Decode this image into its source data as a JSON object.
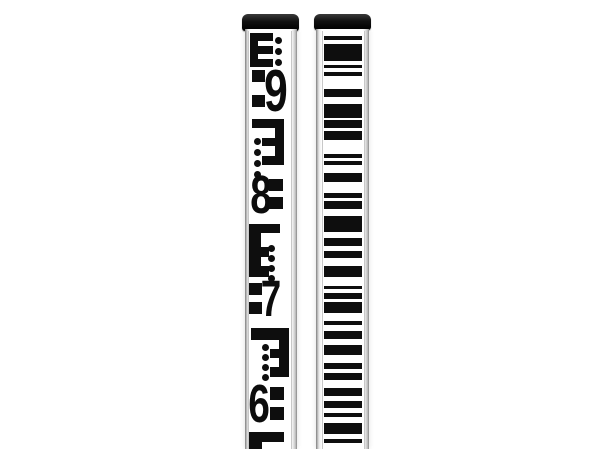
{
  "scene": {
    "description": "Product photograph of two telescopic surveying leveling staffs standing vertically on a white background",
    "background": "#ffffff"
  },
  "colors": {
    "ink": "#0e0e0e",
    "cap": "#141414",
    "aluminum_light": "#f1f1f1",
    "aluminum_dark": "#868686",
    "face": "#ffffff"
  },
  "left_staff": {
    "kind": "E-face metric leveling staff",
    "digits_visible": [
      "9",
      "8",
      "7",
      "6"
    ],
    "face": {
      "x": 245,
      "y": 28,
      "body_w": 52,
      "face_offset": 3,
      "face_w": 42
    },
    "marks": [
      {
        "t": "rect",
        "x": 1,
        "y": 2,
        "w": 8,
        "h": 34
      },
      {
        "t": "rect",
        "x": 1,
        "y": 2,
        "w": 23,
        "h": 8
      },
      {
        "t": "rect",
        "x": 1,
        "y": 15,
        "w": 23,
        "h": 8
      },
      {
        "t": "rect",
        "x": 1,
        "y": 28,
        "w": 23,
        "h": 8
      },
      {
        "t": "dots",
        "x": 26,
        "y": 6,
        "d": 7,
        "gap": 11,
        "n": 4
      },
      {
        "t": "digit",
        "char": "9",
        "x": 16,
        "y": 37,
        "w": 22,
        "h": 46
      },
      {
        "t": "rect",
        "x": 3,
        "y": 39,
        "w": 13,
        "h": 12
      },
      {
        "t": "rect",
        "x": 3,
        "y": 64,
        "w": 13,
        "h": 12
      },
      {
        "t": "rect",
        "x": 3,
        "y": 88,
        "w": 32,
        "h": 9
      },
      {
        "t": "rect",
        "x": 26,
        "y": 88,
        "w": 9,
        "h": 46
      },
      {
        "t": "rect",
        "x": 13,
        "y": 107,
        "w": 22,
        "h": 8
      },
      {
        "t": "rect",
        "x": 13,
        "y": 125,
        "w": 22,
        "h": 9
      },
      {
        "t": "dots",
        "x": 5,
        "y": 107,
        "d": 7,
        "gap": 11,
        "n": 4
      },
      {
        "t": "digit",
        "char": "8",
        "x": 2,
        "y": 143,
        "w": 20,
        "h": 42
      },
      {
        "t": "rect",
        "x": 20,
        "y": 148,
        "w": 14,
        "h": 12
      },
      {
        "t": "rect",
        "x": 20,
        "y": 166,
        "w": 14,
        "h": 12
      },
      {
        "t": "rect",
        "x": 0,
        "y": 193,
        "w": 31,
        "h": 9
      },
      {
        "t": "rect",
        "x": 0,
        "y": 193,
        "w": 12,
        "h": 53
      },
      {
        "t": "rect",
        "x": 0,
        "y": 216,
        "w": 20,
        "h": 10
      },
      {
        "t": "rect",
        "x": 0,
        "y": 235,
        "w": 20,
        "h": 11
      },
      {
        "t": "dots",
        "x": 19,
        "y": 214,
        "d": 7,
        "gap": 10,
        "n": 4
      },
      {
        "t": "digit",
        "char": "7",
        "x": 13,
        "y": 248,
        "w": 18,
        "h": 40
      },
      {
        "t": "rect",
        "x": 0,
        "y": 252,
        "w": 13,
        "h": 12
      },
      {
        "t": "rect",
        "x": 0,
        "y": 271,
        "w": 13,
        "h": 12
      },
      {
        "t": "rect",
        "x": 2,
        "y": 297,
        "w": 38,
        "h": 12
      },
      {
        "t": "rect",
        "x": 30,
        "y": 297,
        "w": 10,
        "h": 49
      },
      {
        "t": "rect",
        "x": 21,
        "y": 318,
        "w": 19,
        "h": 9
      },
      {
        "t": "rect",
        "x": 21,
        "y": 336,
        "w": 19,
        "h": 10
      },
      {
        "t": "dots",
        "x": 13,
        "y": 313,
        "d": 7,
        "gap": 10,
        "n": 4
      },
      {
        "t": "digit",
        "char": "6",
        "x": 0,
        "y": 352,
        "w": 20,
        "h": 42
      },
      {
        "t": "rect",
        "x": 21,
        "y": 356,
        "w": 14,
        "h": 13
      },
      {
        "t": "rect",
        "x": 21,
        "y": 376,
        "w": 14,
        "h": 13
      },
      {
        "t": "rect",
        "x": 0,
        "y": 401,
        "w": 35,
        "h": 10
      },
      {
        "t": "rect",
        "x": 0,
        "y": 401,
        "w": 13,
        "h": 18
      }
    ]
  },
  "right_staff": {
    "kind": "barcode leveling staff for digital levels",
    "face": {
      "x": 316,
      "y": 28,
      "body_w": 53,
      "face_offset": 6,
      "face_w": 41
    },
    "bars": [
      [
        5,
        4
      ],
      [
        13,
        17
      ],
      [
        34,
        3
      ],
      [
        41,
        4
      ],
      [
        58,
        8
      ],
      [
        73,
        14
      ],
      [
        89,
        8
      ],
      [
        100,
        9
      ],
      [
        123,
        4
      ],
      [
        130,
        4
      ],
      [
        142,
        9
      ],
      [
        162,
        5
      ],
      [
        170,
        8
      ],
      [
        185,
        16
      ],
      [
        207,
        8
      ],
      [
        220,
        7
      ],
      [
        235,
        11
      ],
      [
        255,
        3
      ],
      [
        262,
        6
      ],
      [
        271,
        11
      ],
      [
        290,
        4
      ],
      [
        300,
        8
      ],
      [
        314,
        10
      ],
      [
        332,
        6
      ],
      [
        342,
        7
      ],
      [
        357,
        8
      ],
      [
        370,
        7
      ],
      [
        382,
        4
      ],
      [
        392,
        11
      ],
      [
        408,
        4
      ]
    ]
  }
}
